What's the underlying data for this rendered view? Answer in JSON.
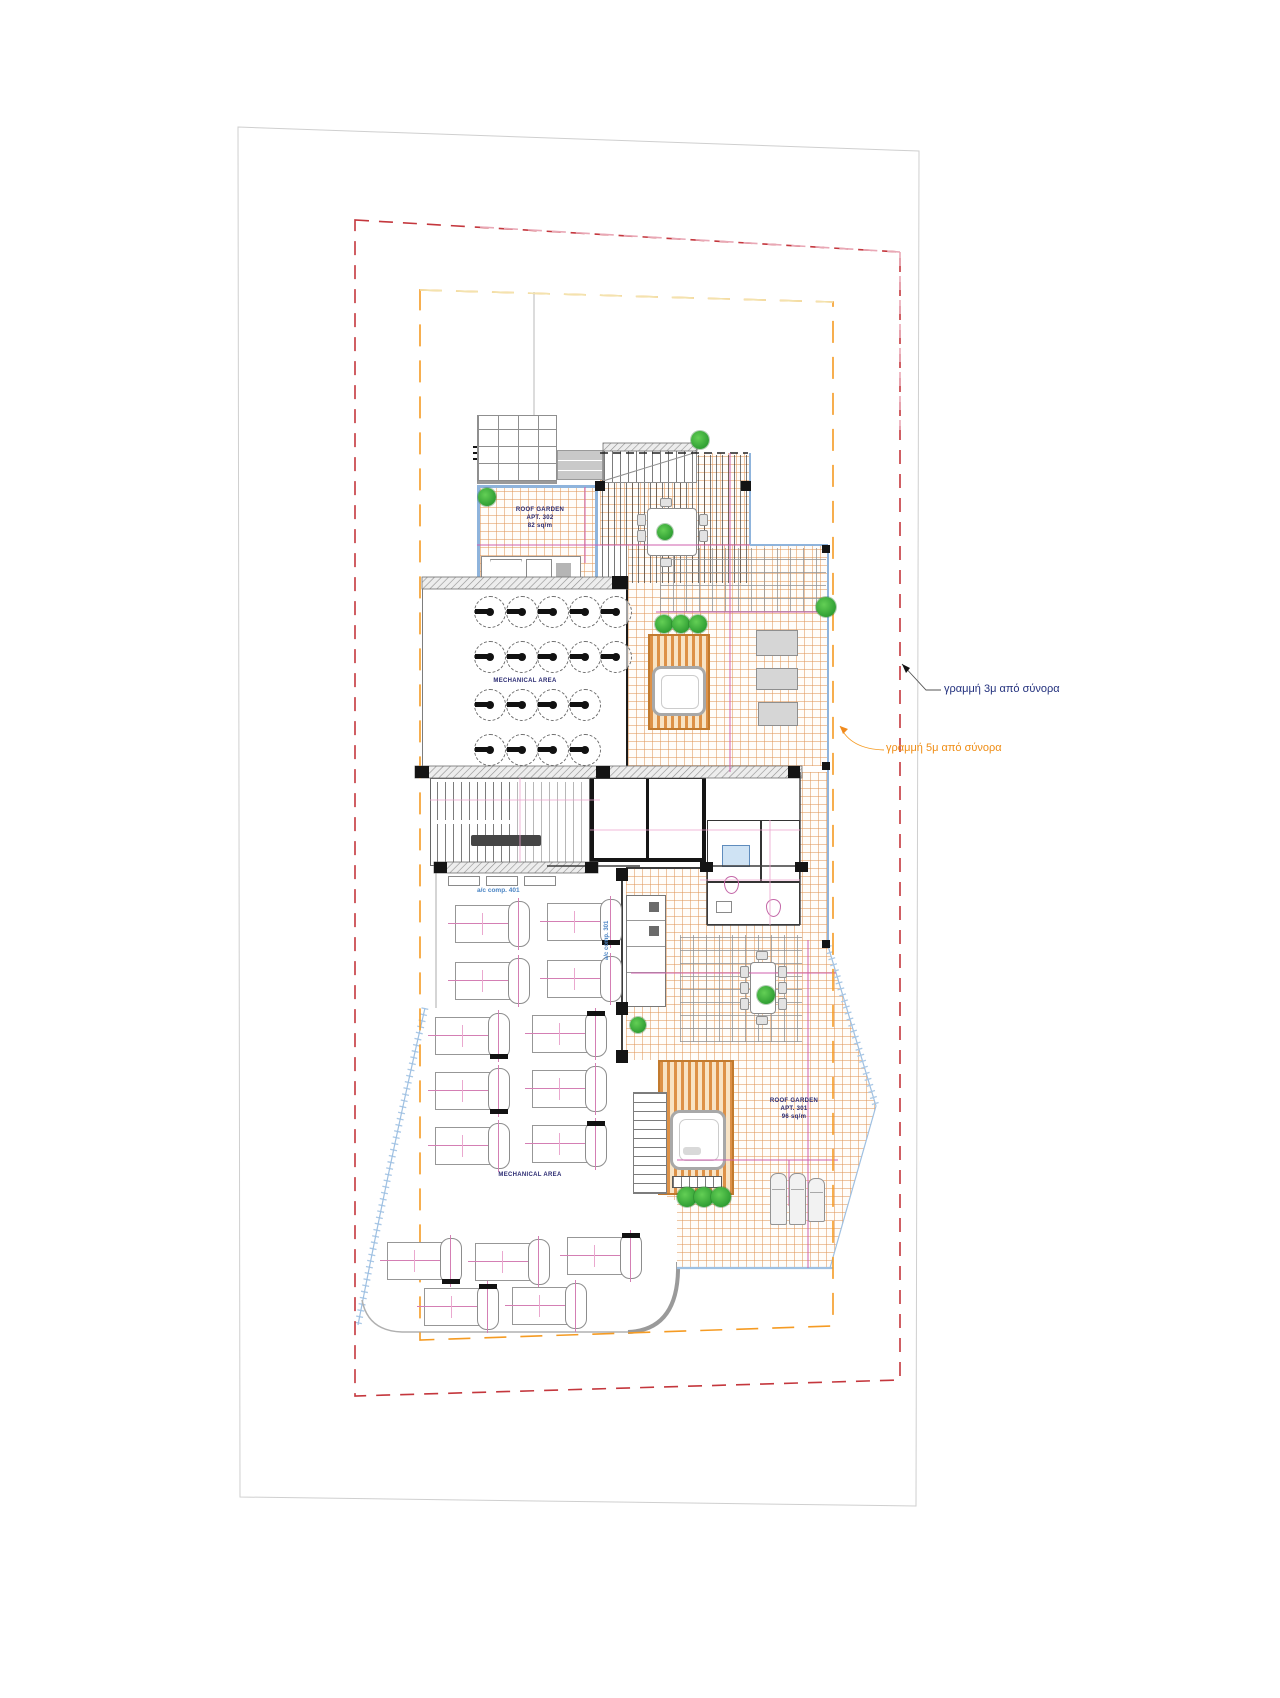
{
  "annotations": {
    "line3m": "γραμμή 3μ από σύνορα",
    "line5m": "γραμμή 5μ από σύνορα"
  },
  "labels": {
    "roof_garden_302": {
      "line1": "ROOF GARDEN",
      "line2": "APT. 302",
      "line3": "82 sq/m"
    },
    "roof_garden_301": {
      "line1": "ROOF GARDEN",
      "line2": "APT. 301",
      "line3": "96 sq/m"
    },
    "mech_upper": "MECHANICAL AREA",
    "mech_lower": "MECHANICAL AREA",
    "ac_comp_401": "a/c comp. 401",
    "ac_comp_301": "a/c comp. 301"
  },
  "colors": {
    "boundary_red": "#c4373d",
    "boundary_red_light": "#e9a8b6",
    "boundary_orange": "#f59b23",
    "boundary_orange_light": "#f3e3ae",
    "paper_edge": "#cfcfcf",
    "tile_line": "#e0985c",
    "magenta_line": "#cf5fae",
    "dim_pink": "#eba3cd",
    "tree_green": "#3cb53c",
    "annotation_blue": "#22307d",
    "annotation_orange": "#ef8d15",
    "water_blue": "#8fb4dc",
    "deck_orange": "#dd9147"
  },
  "plan": {
    "fans": {
      "size": 32,
      "centers": [
        [
          490,
          612
        ],
        [
          522,
          612
        ],
        [
          553,
          612
        ],
        [
          585,
          612
        ],
        [
          616,
          612
        ],
        [
          490,
          657
        ],
        [
          522,
          657
        ],
        [
          553,
          657
        ],
        [
          585,
          657
        ],
        [
          616,
          657
        ],
        [
          490,
          705
        ],
        [
          522,
          705
        ],
        [
          553,
          705
        ],
        [
          585,
          705
        ],
        [
          490,
          750
        ],
        [
          522,
          750
        ],
        [
          553,
          750
        ],
        [
          585,
          750
        ]
      ]
    },
    "ac_units": [
      {
        "x": 455,
        "y": 905,
        "cap": ""
      },
      {
        "x": 547,
        "y": 903,
        "cap": "b"
      },
      {
        "x": 455,
        "y": 962,
        "cap": ""
      },
      {
        "x": 547,
        "y": 960,
        "cap": ""
      },
      {
        "x": 435,
        "y": 1017,
        "cap": "b"
      },
      {
        "x": 532,
        "y": 1015,
        "cap": "t"
      },
      {
        "x": 435,
        "y": 1072,
        "cap": "b"
      },
      {
        "x": 532,
        "y": 1070,
        "cap": ""
      },
      {
        "x": 435,
        "y": 1127,
        "cap": ""
      },
      {
        "x": 532,
        "y": 1125,
        "cap": "t"
      },
      {
        "x": 387,
        "y": 1242,
        "cap": "b"
      },
      {
        "x": 475,
        "y": 1243,
        "cap": ""
      },
      {
        "x": 567,
        "y": 1237,
        "cap": "t"
      },
      {
        "x": 424,
        "y": 1288,
        "cap": "t"
      },
      {
        "x": 512,
        "y": 1287,
        "cap": ""
      }
    ],
    "trees": [
      [
        487,
        497,
        9
      ],
      [
        665,
        532,
        8
      ],
      [
        700,
        440,
        9
      ],
      [
        664,
        624,
        9
      ],
      [
        681,
        624,
        9
      ],
      [
        698,
        624,
        9
      ],
      [
        826,
        607,
        10
      ],
      [
        766,
        995,
        9
      ],
      [
        638,
        1025,
        8
      ],
      [
        687,
        1197,
        10
      ],
      [
        704,
        1197,
        10
      ],
      [
        721,
        1197,
        10
      ]
    ],
    "blocks": [
      [
        612,
        576,
        16,
        13
      ],
      [
        415,
        766,
        14,
        12
      ],
      [
        596,
        766,
        14,
        12
      ],
      [
        788,
        766,
        12,
        12
      ],
      [
        434,
        862,
        13,
        11
      ],
      [
        585,
        862,
        13,
        11
      ],
      [
        700,
        862,
        13,
        10
      ],
      [
        795,
        862,
        13,
        10
      ],
      [
        595,
        481,
        10,
        10
      ],
      [
        741,
        481,
        10,
        10
      ],
      [
        822,
        545,
        8,
        8
      ],
      [
        822,
        762,
        8,
        8
      ],
      [
        822,
        940,
        8,
        8
      ],
      [
        616,
        868,
        12,
        13
      ],
      [
        616,
        1002,
        12,
        13
      ],
      [
        616,
        1050,
        12,
        13
      ]
    ],
    "sofas": [
      [
        756,
        630,
        42,
        26
      ],
      [
        756,
        668,
        42,
        22
      ],
      [
        758,
        702,
        40,
        24
      ]
    ],
    "loungers": [
      [
        770,
        1173,
        17,
        52
      ],
      [
        789,
        1173,
        17,
        52
      ],
      [
        808,
        1178,
        17,
        44
      ]
    ],
    "chairs": [
      [
        637,
        514,
        9,
        12
      ],
      [
        637,
        530,
        9,
        12
      ],
      [
        699,
        514,
        9,
        12
      ],
      [
        699,
        530,
        9,
        12
      ],
      [
        660,
        498,
        12,
        9
      ],
      [
        660,
        558,
        12,
        9
      ],
      [
        740,
        966,
        9,
        12
      ],
      [
        740,
        982,
        9,
        12
      ],
      [
        740,
        998,
        9,
        12
      ],
      [
        778,
        966,
        9,
        12
      ],
      [
        778,
        982,
        9,
        12
      ],
      [
        778,
        998,
        9,
        12
      ],
      [
        756,
        951,
        12,
        9
      ],
      [
        756,
        1016,
        12,
        9
      ]
    ],
    "vent_boxes": [
      [
        448,
        876,
        32,
        10
      ],
      [
        486,
        876,
        32,
        10
      ],
      [
        524,
        876,
        32,
        10
      ]
    ]
  }
}
